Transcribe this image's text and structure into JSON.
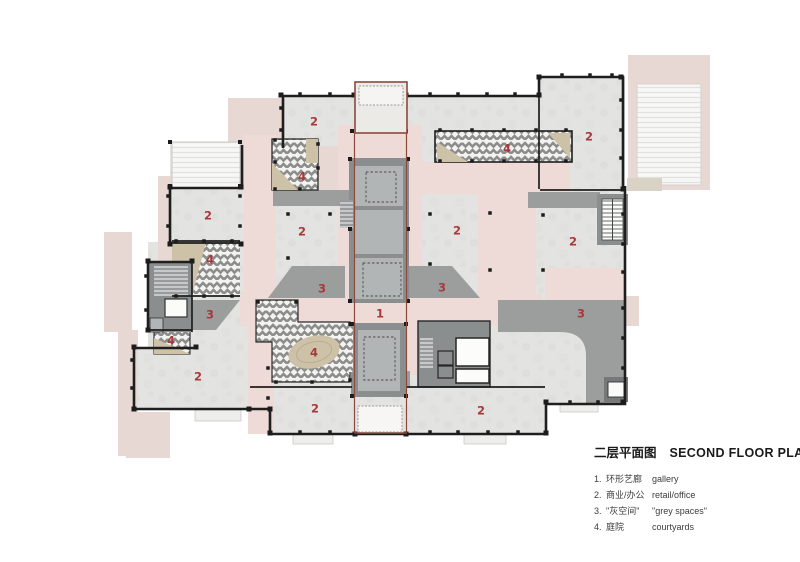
{
  "title": {
    "zh": "二层平面图",
    "en": "SECOND FLOOR PLAN"
  },
  "legend": {
    "items": [
      {
        "num": "1.",
        "zh": "环形艺廊",
        "en": "gallery"
      },
      {
        "num": "2.",
        "zh": "商业/办公",
        "en": "retail/office"
      },
      {
        "num": "3.",
        "zh": "\"灰空间\"",
        "en": "\"grey spaces\""
      },
      {
        "num": "4.",
        "zh": "庭院",
        "en": "courtyards"
      }
    ]
  },
  "plan": {
    "labels": [
      {
        "n": "1",
        "x": 380,
        "y": 314
      },
      {
        "n": "2",
        "x": 314,
        "y": 122
      },
      {
        "n": "2",
        "x": 589,
        "y": 137
      },
      {
        "n": "2",
        "x": 208,
        "y": 216
      },
      {
        "n": "2",
        "x": 302,
        "y": 232
      },
      {
        "n": "2",
        "x": 457,
        "y": 231
      },
      {
        "n": "2",
        "x": 573,
        "y": 242
      },
      {
        "n": "2",
        "x": 198,
        "y": 377
      },
      {
        "n": "2",
        "x": 315,
        "y": 409
      },
      {
        "n": "2",
        "x": 481,
        "y": 411
      },
      {
        "n": "3",
        "x": 322,
        "y": 289
      },
      {
        "n": "3",
        "x": 442,
        "y": 288
      },
      {
        "n": "3",
        "x": 210,
        "y": 315
      },
      {
        "n": "3",
        "x": 581,
        "y": 314
      },
      {
        "n": "4",
        "x": 507,
        "y": 149
      },
      {
        "n": "4",
        "x": 302,
        "y": 177
      },
      {
        "n": "4",
        "x": 210,
        "y": 260
      },
      {
        "n": "4",
        "x": 171,
        "y": 341
      },
      {
        "n": "4",
        "x": 314,
        "y": 353
      }
    ]
  },
  "colors": {
    "label_red": "#a63a3b",
    "gallery_pink": "#eedad6",
    "outer_pink": "#e7d8d4",
    "room_grey": "#e3e3e2",
    "grey_space": "#9c9e9d",
    "core_grey": "#8b8e8f",
    "courtyard_beige": "#cdc2a8",
    "outline_red": "#8a4a3e",
    "wall_black": "#1e1e1e",
    "legend_text": "#1a1a1a"
  }
}
